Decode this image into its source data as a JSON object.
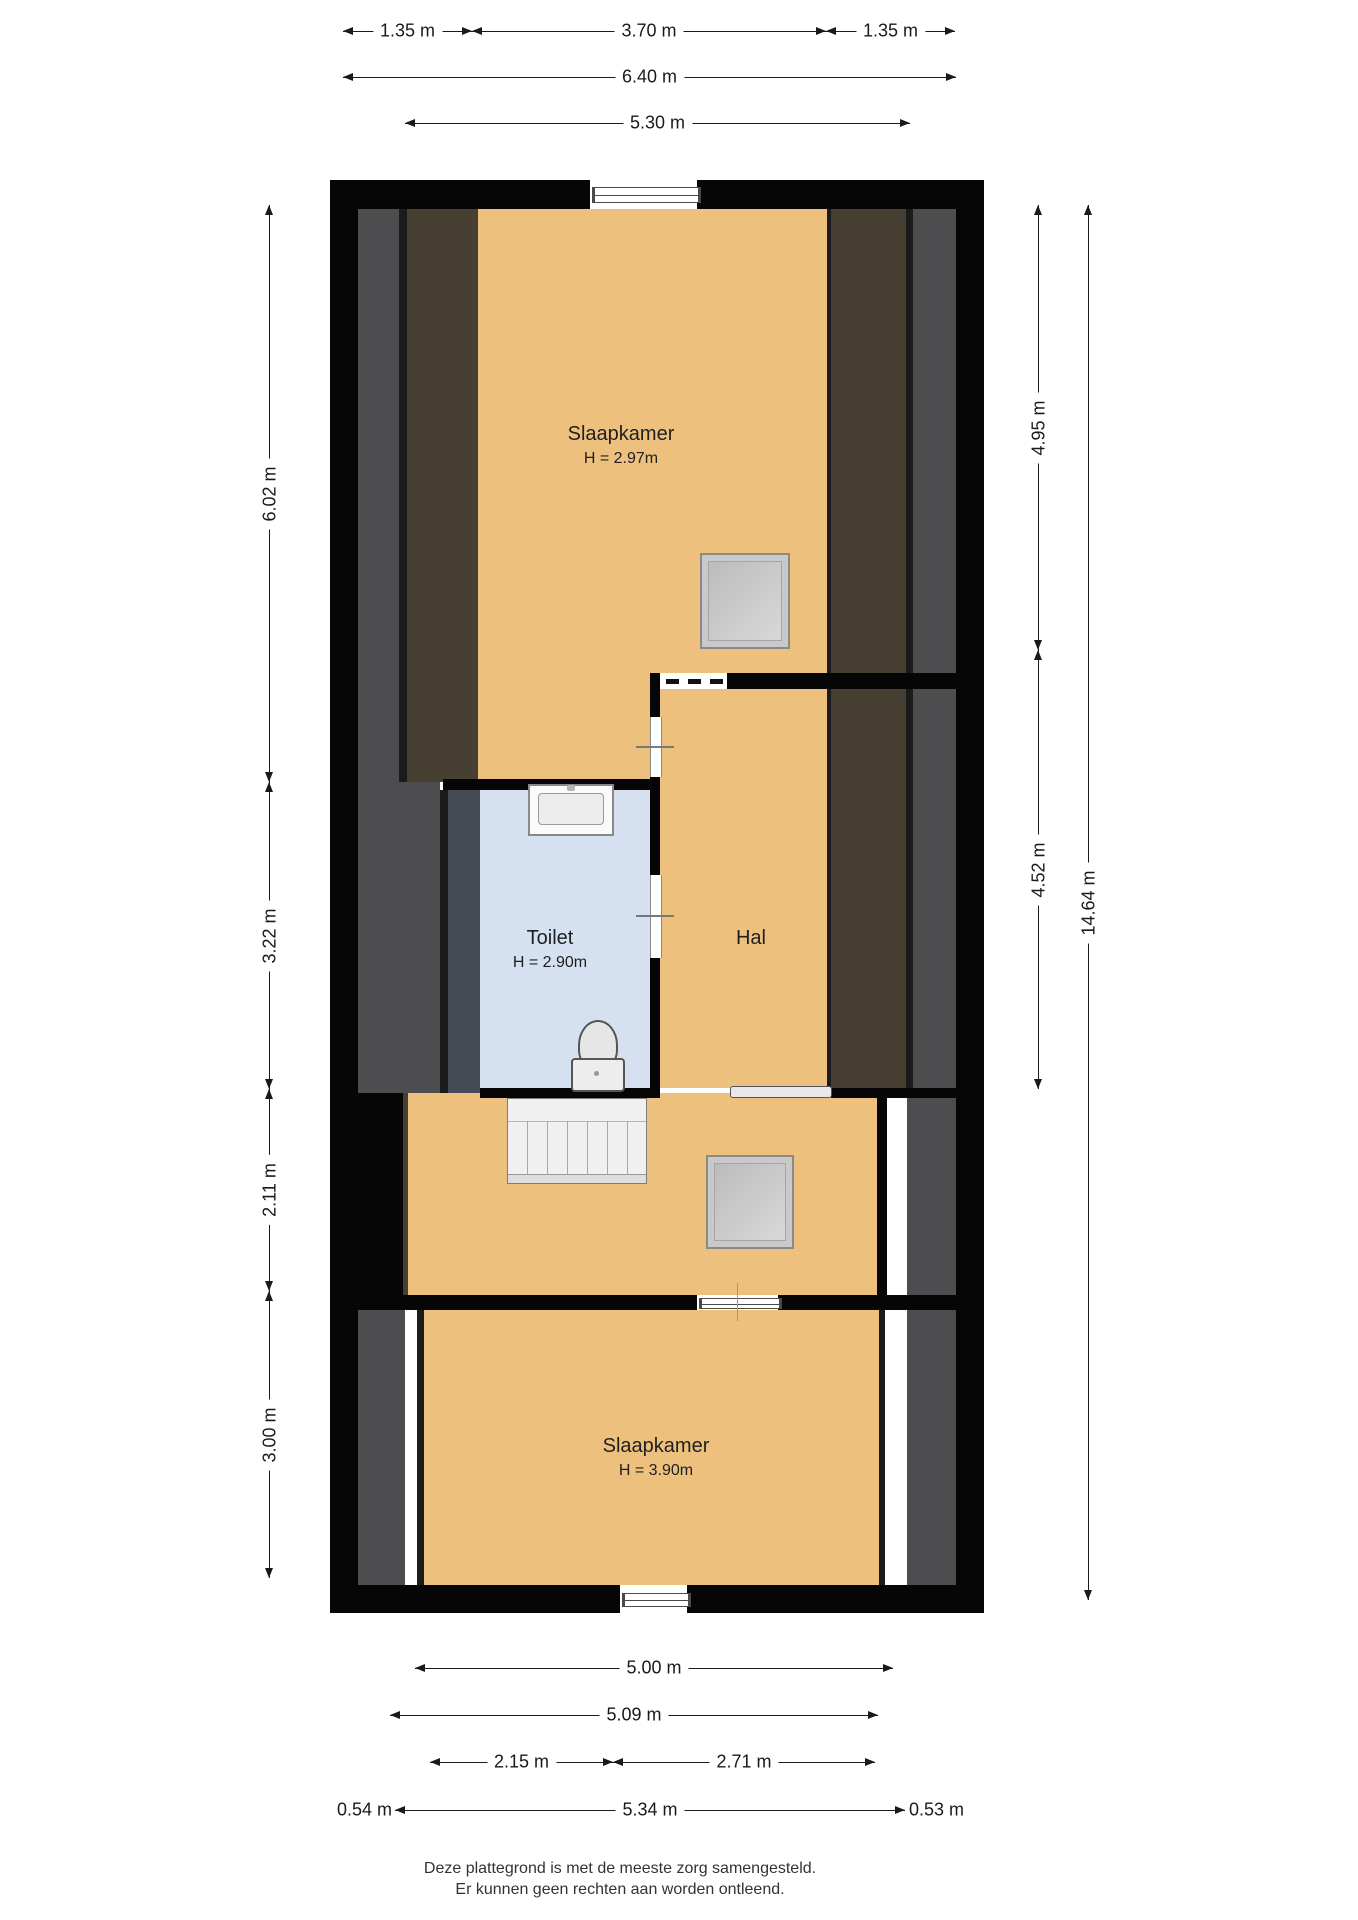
{
  "rooms": {
    "bedroom_top": {
      "name": "Slaapkamer",
      "height": "H = 2.97m"
    },
    "toilet": {
      "name": "Toilet",
      "height": "H = 2.90m"
    },
    "hall": {
      "name": "Hal"
    },
    "bedroom_bottom": {
      "name": "Slaapkamer",
      "height": "H = 3.90m"
    }
  },
  "dimensions": {
    "top": {
      "seg1": "1.35 m",
      "seg2": "3.70 m",
      "seg3": "1.35 m",
      "total": "6.40 m",
      "inner": "5.30 m"
    },
    "bottom": {
      "row1": "5.00 m",
      "row2": "5.09 m",
      "row3a": "2.15 m",
      "row3b": "2.71 m",
      "row4_left": "0.54 m",
      "row4_mid": "5.34 m",
      "row4_right": "0.53 m"
    },
    "left": {
      "seg1": "6.02 m",
      "seg2": "3.22 m",
      "seg3": "2.11 m",
      "seg4": "3.00 m"
    },
    "right": {
      "seg1": "4.95 m",
      "seg2": "4.52 m",
      "total": "14.64 m"
    }
  },
  "footer": {
    "line1": "Deze plattegrond is met de meeste zorg samengesteld.",
    "line2": "Er kunnen geen rechten aan worden ontleend."
  },
  "colors": {
    "floor_orange": "#edc17d",
    "toilet_blue": "#d5e1f0",
    "roof_brown": "#483f33",
    "roof_gray": "#4d4d4f",
    "roof_bluegray": "#454b54",
    "wall_black": "#060606"
  }
}
